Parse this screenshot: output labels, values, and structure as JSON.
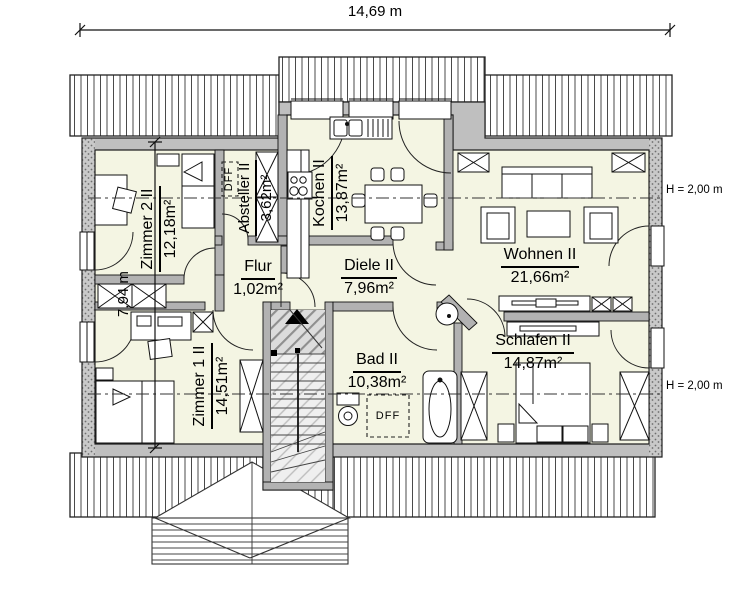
{
  "plan": {
    "dimensions": {
      "width": "14,69 m",
      "height": "7,94 m"
    },
    "height_markers": {
      "upper": "H = 2,00 m",
      "lower": "H = 2,00 m"
    },
    "rooms": {
      "zimmer2": {
        "name": "Zimmer 2 II",
        "area": "12,18m²"
      },
      "absteller": {
        "name": "Absteller II",
        "area": "3,62m²"
      },
      "kochen": {
        "name": "Kochen II",
        "area": "13,87m²"
      },
      "flur": {
        "name": "Flur",
        "area": "1,02m²"
      },
      "diele": {
        "name": "Diele II",
        "area": "7,96m²"
      },
      "wohnen": {
        "name": "Wohnen II",
        "area": "21,66m²"
      },
      "zimmer1": {
        "name": "Zimmer 1 II",
        "area": "14,51m²"
      },
      "bad": {
        "name": "Bad II",
        "area": "10,38m²"
      },
      "schlafen": {
        "name": "Schlafen II",
        "area": "14,87m²"
      }
    },
    "annotations": {
      "dff_absteller": "DFF",
      "dff_bad": "DFF"
    },
    "colors": {
      "room_fill": "#f4f5e3",
      "wall_fill": "#bfbfbf",
      "partition_fill": "#b2b2b2",
      "line": "#1b1b1b"
    }
  }
}
